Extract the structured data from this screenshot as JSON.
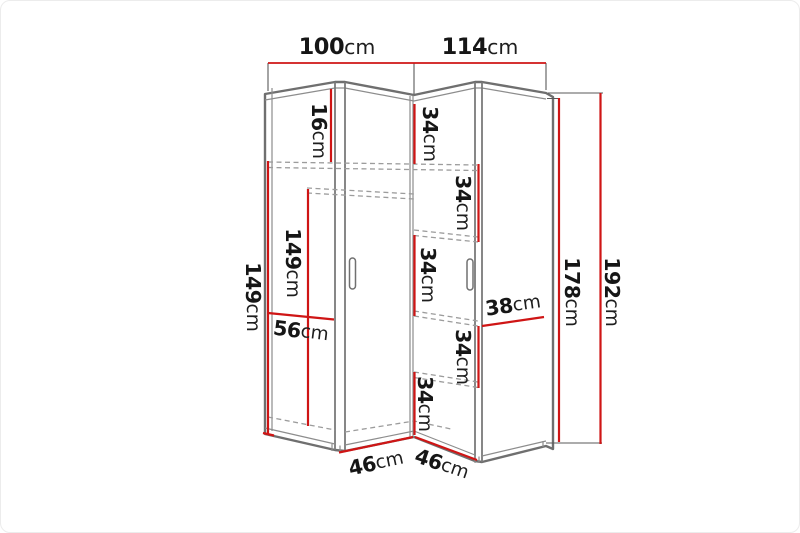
{
  "page": {
    "background": "#ffffff",
    "border_color": "#ececec"
  },
  "diagram": {
    "type": "furniture-dimension-drawing",
    "subject": "corner wardrobe front view with dimension lines",
    "unit": "cm",
    "colors": {
      "dimension_line": "#cf1515",
      "outline": "#6f6f6f",
      "dashed_shelf_line": "#9c9c9c",
      "label_text": "#161616"
    },
    "labels": {
      "width_left": {
        "value": "100",
        "unit": "cm"
      },
      "width_right": {
        "value": "114",
        "unit": "cm"
      },
      "top_gap": {
        "value": "16",
        "unit": "cm"
      },
      "shelf_a": {
        "value": "34",
        "unit": "cm"
      },
      "shelf_b": {
        "value": "34",
        "unit": "cm"
      },
      "shelf_c": {
        "value": "34",
        "unit": "cm"
      },
      "shelf_d": {
        "value": "34",
        "unit": "cm"
      },
      "shelf_e": {
        "value": "34",
        "unit": "cm"
      },
      "height_left_outer": {
        "value": "149",
        "unit": "cm"
      },
      "height_left_inner": {
        "value": "149",
        "unit": "cm"
      },
      "width_left_front": {
        "value": "56",
        "unit": "cm"
      },
      "width_right_front": {
        "value": "38",
        "unit": "cm"
      },
      "height_front": {
        "value": "178",
        "unit": "cm"
      },
      "height_total": {
        "value": "192",
        "unit": "cm"
      },
      "depth_left": {
        "value": "46",
        "unit": "cm"
      },
      "depth_right": {
        "value": "46",
        "unit": "cm"
      }
    }
  }
}
